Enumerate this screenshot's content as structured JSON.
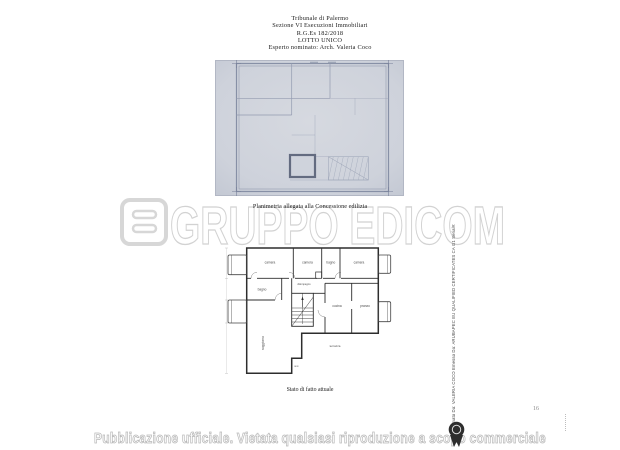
{
  "document": {
    "header": {
      "lines": [
        "Tribunale di Palermo",
        "Sezione VI Esecuzioni Immobiliari",
        "R.G.Es 182/2018",
        "LOTTO UNICO",
        "Esperto nominato: Arch. Valeria Coco"
      ]
    },
    "plan_concessione": {
      "caption": "Planimetria allegata alla Concessione edilizia"
    },
    "plan_stato": {
      "caption": "Stato di fatto attuale",
      "room_labels": {
        "r1": "camera",
        "r2": "camera",
        "r3": "bagno",
        "r4": "camera",
        "r5": "disimpegno",
        "r6": "bagno",
        "r7": "cucina",
        "r8": "pranzo",
        "r9": "soggiorno",
        "r10": "terrazza",
        "r11": "w.c."
      }
    },
    "watermark": {
      "text": "GRUPPO EDICOM",
      "logo": "edicom-e-logo"
    },
    "signature": {
      "stamp": "Firmato Da: VALERIA COCO Emesso Da: ARUBAPEC EU QUALIFIED CERTIFICATES CA G1 Serial#:"
    },
    "page_number": "16",
    "footer": {
      "text": "Pubblicazione ufficiale. Vietata qualsiasi riproduzione a scopo commerciale",
      "icon": "award-ribbon-icon"
    },
    "colors": {
      "scan_background": "#ced2db",
      "scan_lines": "#8e96aa",
      "plan_lines": "#2d2d2d",
      "watermark": "#d4d4d4",
      "footer_outline": "#b8b8b8",
      "seal": "#2e2e2e"
    }
  }
}
